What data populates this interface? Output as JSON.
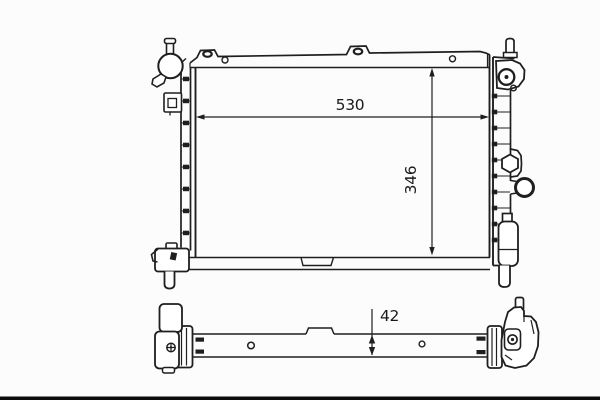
{
  "drawing": {
    "kind": "radiator-two-view-technical-drawing",
    "line_color": "#1f1f1f",
    "background_color": "#fcfcfc",
    "bottom_bar_color": "#0b0b0b",
    "views": {
      "front": {
        "dimension_width": "530",
        "dimension_height": "346"
      },
      "plan": {
        "dimension_depth": "42"
      }
    }
  }
}
